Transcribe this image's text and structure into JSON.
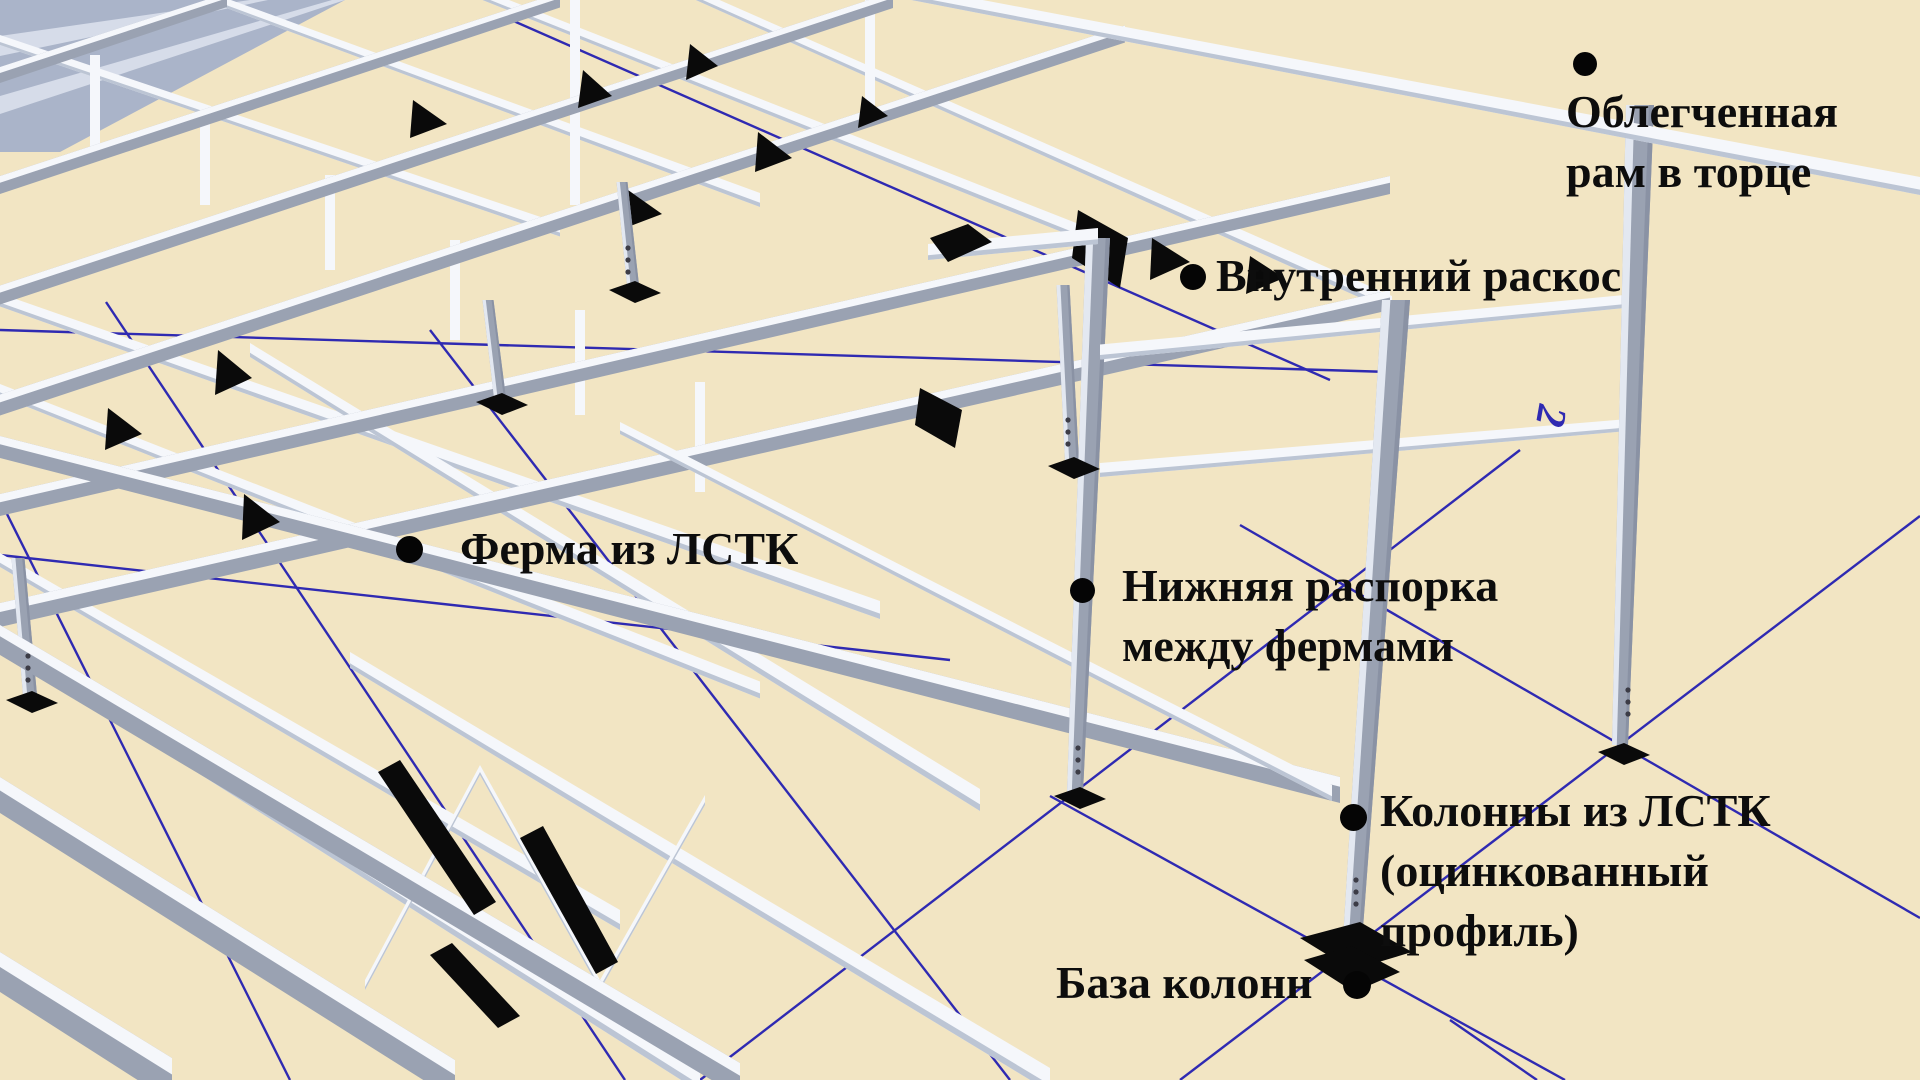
{
  "callouts": {
    "end_frame": {
      "line1": "Облегченная",
      "line2": "рам в торце"
    },
    "inner_brace": {
      "line1": "Внутренний раскос"
    },
    "truss": {
      "line1": "Ферма из ЛСТК"
    },
    "bottom_strut": {
      "line1": "Нижняя распорка",
      "line2": "между фермами"
    },
    "columns": {
      "line1": "Колонны из ЛСТК",
      "line2": "(оцинкованный",
      "line3": "профиль)"
    },
    "column_base": {
      "line1": "База колонн"
    }
  },
  "axis_labels": {
    "grid_2": "2"
  },
  "colors": {
    "background": "#f2e5c3",
    "grid_line": "#2f2ab2",
    "steel_light": "#f5f7fb",
    "steel_mid": "#e3e8f1",
    "steel_shadow": "#9aa2b2",
    "steel_dark": "#8a92a4",
    "sheeting": "#aab4c9",
    "sheeting_stripe": "#d6dce9",
    "gusset": "#0a0a0a",
    "text": "#0d0d0d"
  }
}
